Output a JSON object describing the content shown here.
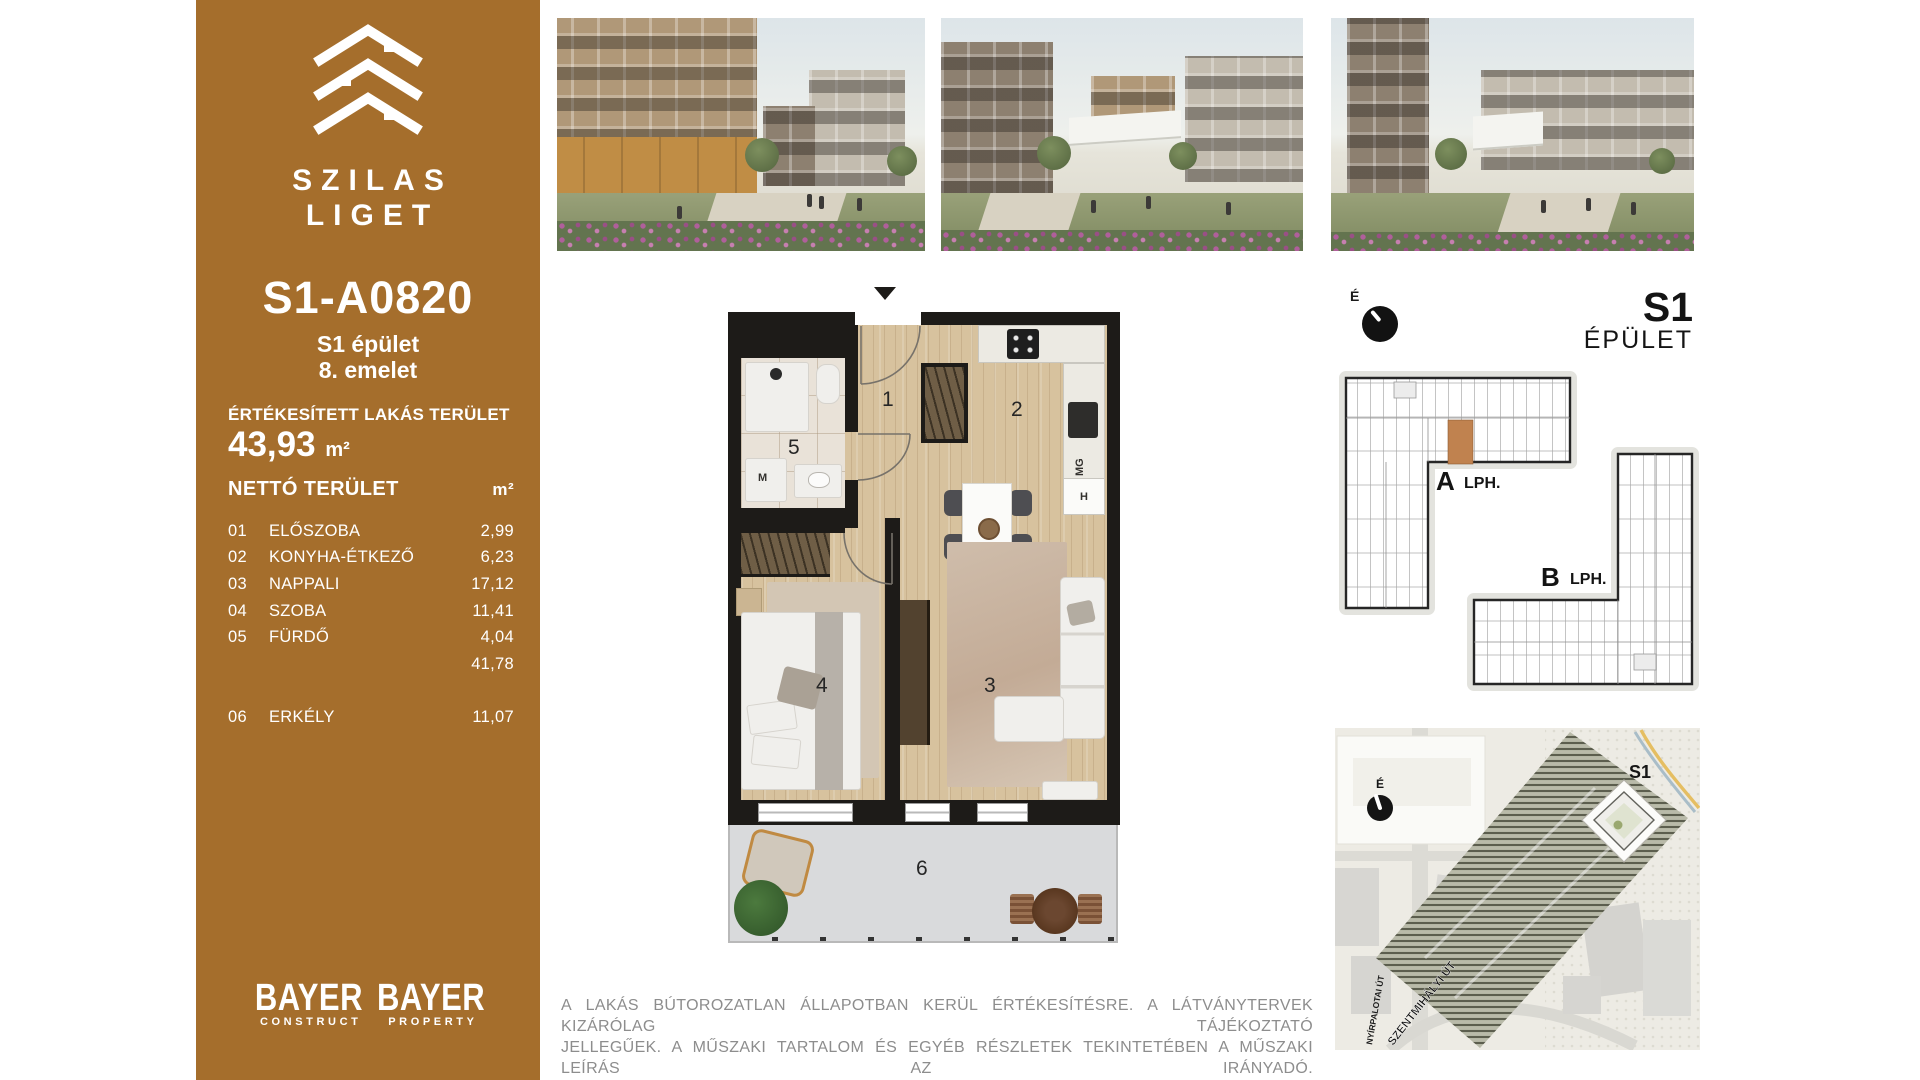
{
  "colors": {
    "accent_brown": "#A56E2C",
    "plan_wall": "#1D1B18",
    "unit_highlight": "#C0824F"
  },
  "sidebar": {
    "brand_line1": "SZILAS",
    "brand_line2": "LIGET",
    "unit_code": "S1-A0820",
    "building_line": "S1 épület",
    "floor_line": "8. emelet",
    "sold_area_label": "ÉRTÉKESÍTETT LAKÁS TERÜLET",
    "sold_area_value": "43,93",
    "sold_area_unit": "m²",
    "table": {
      "header_label": "NETTÓ TERÜLET",
      "header_unit": "m²",
      "rows": [
        {
          "no": "01",
          "name": "ELŐSZOBA",
          "area": "2,99"
        },
        {
          "no": "02",
          "name": "KONYHA-ÉTKEZŐ",
          "area": "6,23"
        },
        {
          "no": "03",
          "name": "NAPPALI",
          "area": "17,12"
        },
        {
          "no": "04",
          "name": "SZOBA",
          "area": "11,41"
        },
        {
          "no": "05",
          "name": "FÜRDŐ",
          "area": "4,04"
        },
        {
          "no": "",
          "name": "",
          "area": "41,78"
        },
        {
          "no": "06",
          "name": "ERKÉLY",
          "area": "11,07"
        }
      ]
    },
    "logos": [
      {
        "brand": "BAYER",
        "sub": "CONSTRUCT"
      },
      {
        "brand": "BAYER",
        "sub": "PROPERTY"
      }
    ]
  },
  "floorplan": {
    "labels": {
      "hall": "1",
      "kitchen": "2",
      "living": "3",
      "bedroom": "4",
      "bath": "5",
      "balcony": "6"
    },
    "appliances": {
      "washer": "M",
      "dishwasher": "MG",
      "fridge": "H"
    }
  },
  "right_panel": {
    "compass_label": "É",
    "building_code": "S1",
    "building_word": "ÉPÜLET",
    "staircase_a_letter": "A",
    "staircase_a_suffix": "LPH.",
    "staircase_b_letter": "B",
    "staircase_b_suffix": "LPH.",
    "site_map": {
      "compass_label": "É",
      "building_label": "S1",
      "street1": "NYÍRPALOTAI ÚT",
      "street2": "SZENTMIHÁLYI ÚT"
    }
  },
  "footer": {
    "disclaimer_line1": "A LAKÁS BÚTOROZATLAN ÁLLAPOTBAN KERÜL ÉRTÉKESÍTÉSRE. A LÁTVÁNYTERVEK KIZÁRÓLAG TÁJÉKOZTATÓ",
    "disclaimer_line2": "JELLEGŰEK. A MŰSZAKI TARTALOM ÉS EGYÉB RÉSZLETEK TEKINTETÉBEN A MŰSZAKI LEÍRÁS AZ IRÁNYADÓ."
  }
}
